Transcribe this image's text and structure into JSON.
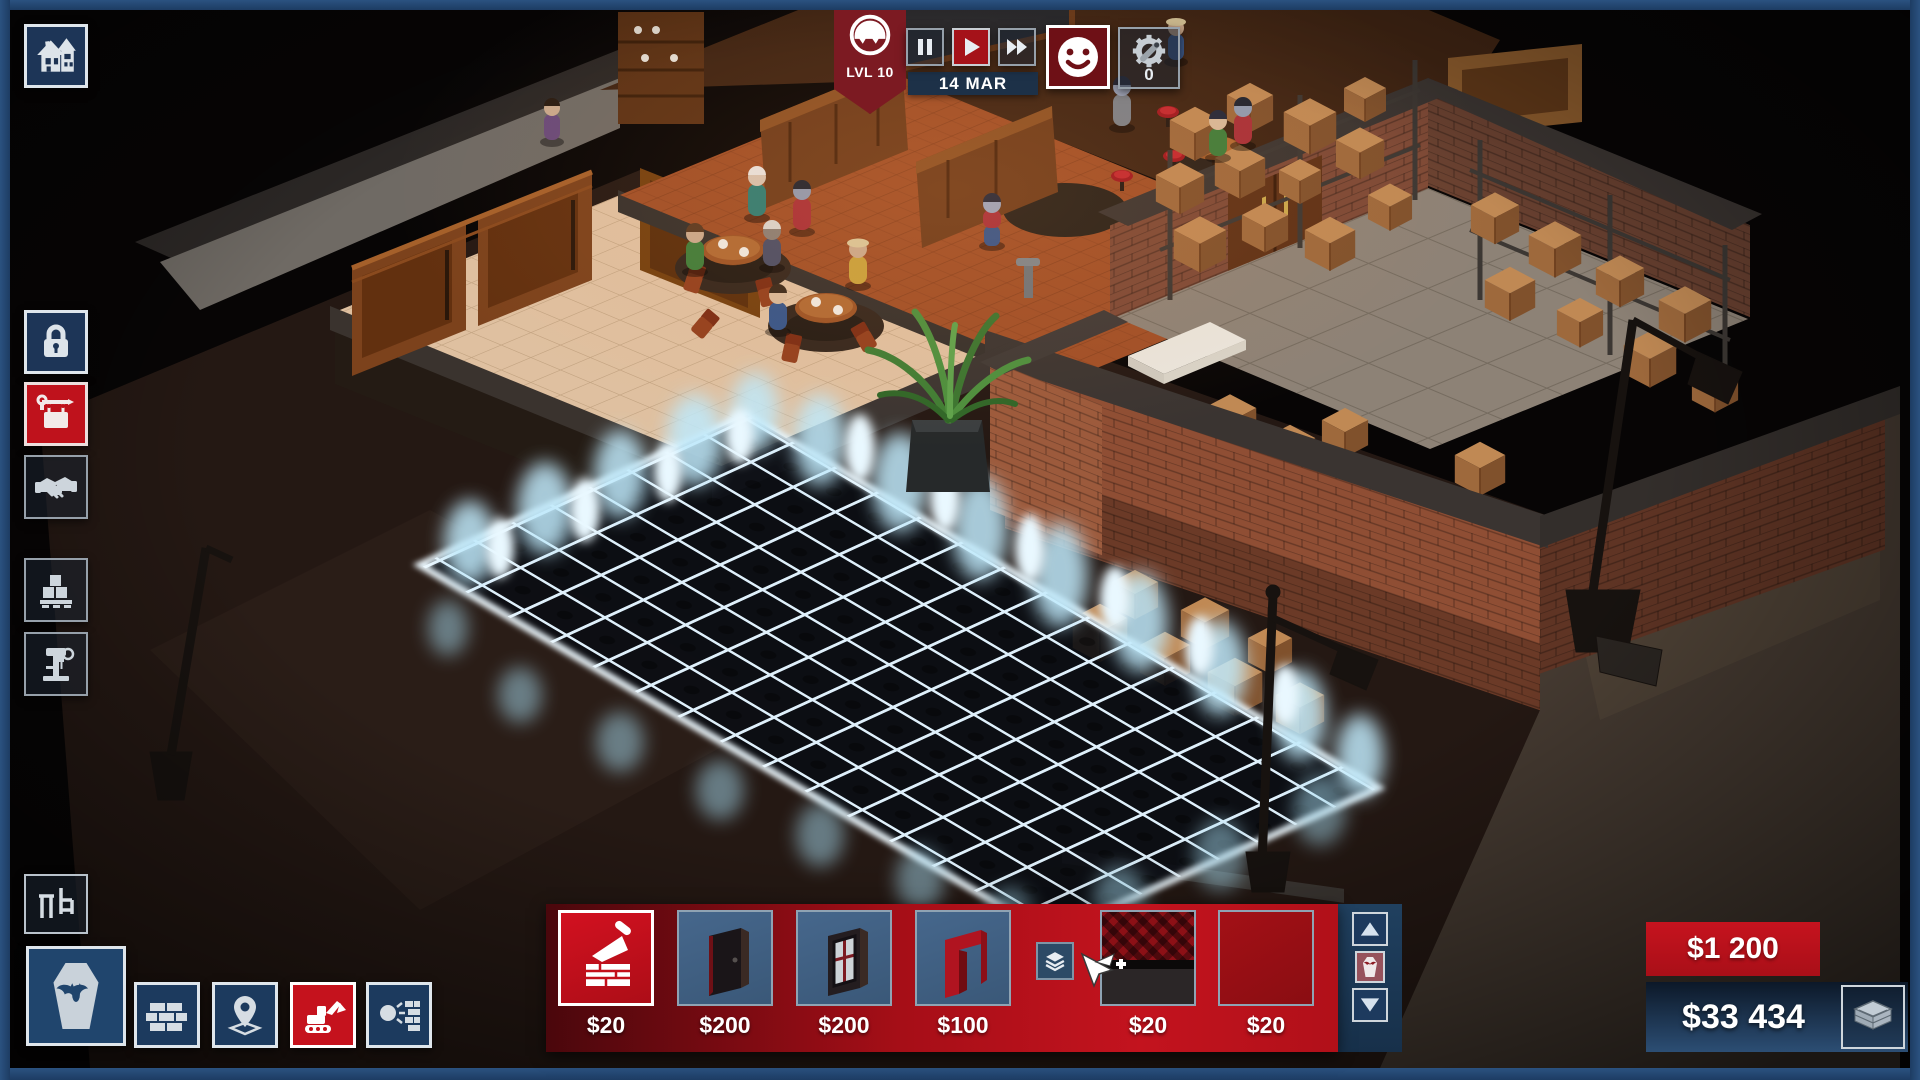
{
  "top_bar": {
    "level_badge": {
      "label": "LVL 10",
      "icon": "undertaker-face-icon"
    },
    "date": "14 MAR",
    "playback": {
      "active": "play",
      "icons": [
        "pause",
        "play",
        "fast-forward"
      ]
    },
    "mood_button": {
      "icon": "smiley-face-icon"
    },
    "alerts_button": {
      "icon": "gear-wrench-icon",
      "count": "0"
    }
  },
  "top_left": {
    "home_button": {
      "icon": "haunted-house-icon"
    }
  },
  "toolbar_left": {
    "items": [
      {
        "icon": "padlock-icon",
        "active": false
      },
      {
        "icon": "hanging-sign-icon",
        "active": true
      },
      {
        "icon": "handshake-icon",
        "active": false
      },
      {
        "icon": "pallet-boxes-icon",
        "active": false
      },
      {
        "icon": "drill-press-icon",
        "active": false
      }
    ]
  },
  "bottom_left": {
    "furniture_button": {
      "icon": "chair-table-icon"
    },
    "coffin_button": {
      "icon": "coffin-bat-icon"
    },
    "tools": [
      {
        "icon": "bricks-icon",
        "active": false
      },
      {
        "icon": "map-pin-icon",
        "active": false
      },
      {
        "icon": "excavator-icon",
        "active": true
      },
      {
        "icon": "wrecking-ball-icon",
        "active": false
      }
    ]
  },
  "build_palette": {
    "items": [
      {
        "icon": "trowel-bricks-icon",
        "price": "$20",
        "selected": true
      },
      {
        "icon": "dark-door-icon",
        "price": "$200",
        "selected": false
      },
      {
        "icon": "coffin-window-door-icon",
        "price": "$200",
        "selected": false
      },
      {
        "icon": "red-doorframe-icon",
        "price": "$100",
        "selected": false
      },
      {
        "icon": "checkered-carpet-icon",
        "price": "$20",
        "selected": false
      },
      {
        "icon": "red-floor-icon",
        "price": "$20",
        "selected": false
      }
    ],
    "layers_button": {
      "icon": "layers-icon"
    },
    "scroll": {
      "up": "arrow-up-icon",
      "middle": "coffin-mini-icon",
      "down": "arrow-down-icon"
    }
  },
  "money": {
    "daily": "$1 200",
    "balance": "$33 434",
    "icon": "banknotes-icon"
  },
  "colors": {
    "accent_red": "#c5121d",
    "dark_red": "#7c1a22",
    "panel_navy": "#1d3557",
    "frame_navy": "#24497a",
    "grid_glow": "#d7ecf9",
    "money_navy": "#16263c"
  }
}
